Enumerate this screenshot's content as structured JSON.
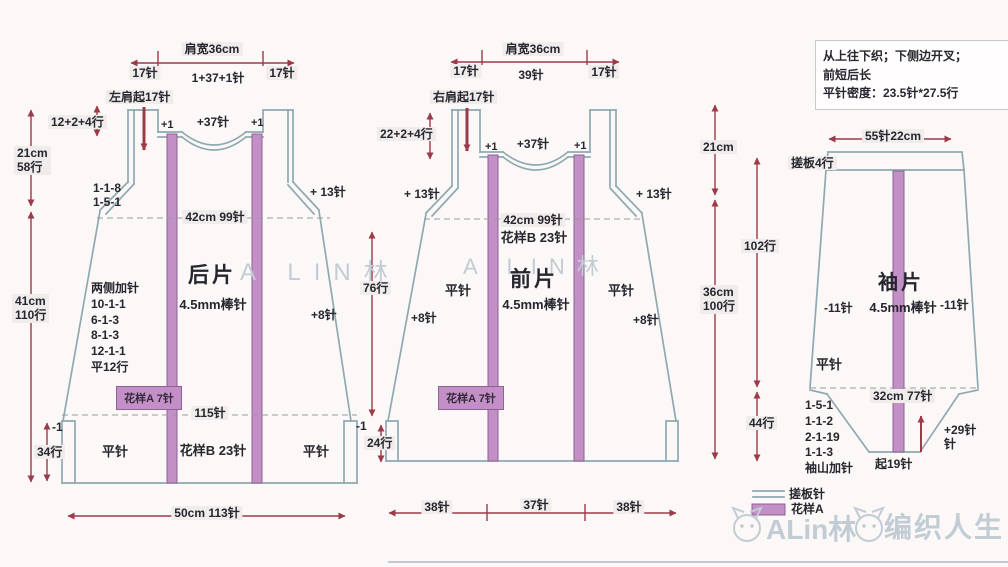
{
  "info_box": {
    "line1": "从上往下织；下侧边开叉；",
    "line2": "前短后长",
    "line3": "平针密度：23.5针*27.5行"
  },
  "back": {
    "title": "后片",
    "needle": "4.5mm棒针",
    "shoulder_width": "肩宽36cm",
    "seg_left": "17针",
    "seg_center": "1+37+1针",
    "seg_right": "17针",
    "shoulder_start": "左肩起17针",
    "shoulder_rows": "12+2+4行",
    "plus1_left": "+1",
    "neck_sts": "+37针",
    "plus1_right": "+1",
    "armhole_left": "1-1-8\n1-5-1",
    "armhole_right": "+ 13针",
    "yoke_len": "21cm\n58行",
    "body_len": "41cm\n110行",
    "chest": "42cm 99针",
    "side_inc": "两侧加针\n10-1-1\n6-1-3\n8-1-3\n12-1-1\n平12行",
    "inc_right": "+8针",
    "patternA": "花样A 7针",
    "hem_sts": "115针",
    "patternB": "花样B 23针",
    "stockinette_left": "平针",
    "stockinette_right": "平针",
    "minus1": "-1",
    "hem_rows": "34行",
    "bottom_width": "50cm 113针"
  },
  "front": {
    "title": "前片",
    "needle": "4.5mm棒针",
    "shoulder_width": "肩宽36cm",
    "seg_left": "17针",
    "seg_center": "39针",
    "seg_right": "17针",
    "shoulder_start": "右肩起17针",
    "shoulder_rows": "22+2+4行",
    "plus1_left": "+1",
    "neck_sts": "+37针",
    "plus1_right": "+1",
    "armhole_left": "+ 13针",
    "armhole_right": "+ 13针",
    "chest": "42cm 99针",
    "patternB": "花样B 23针",
    "stockinette_left": "平针",
    "stockinette_right": "平针",
    "inc_left": "+8针",
    "inc_right": "+8针",
    "patternA": "花样A 7针",
    "mid_rows": "76行",
    "minus1": "-1",
    "hem_rows": "24行",
    "bottom_left": "38针",
    "bottom_center": "37针",
    "bottom_right": "38针"
  },
  "sleeve": {
    "title": "袖片",
    "needle": "4.5mm棒针",
    "top_width": "55针22cm",
    "garter": "搓板4行",
    "len_top": "21cm",
    "len_body": "36cm\n100行",
    "rows_upper": "102行",
    "rows_cap": "44行",
    "dec_left": "-11针",
    "dec_right": "-11针",
    "stockinette": "平针",
    "underarm": "32cm 77针",
    "cap_shaping": "1-5-1\n1-1-2\n2-1-19\n1-1-3\n袖山加针",
    "cast_on": "起19针",
    "cap_inc": "+29针\n针"
  },
  "legend": {
    "garter_label": "搓板针",
    "patternA_label": "花样A"
  },
  "watermark": {
    "center_back": "A LIN林",
    "center_front": "A LIN林",
    "brand_name": "ALin林",
    "brand_site": "编织人生"
  },
  "colors": {
    "outline": "#8fa9b1",
    "pattern_fill": "#c28fc6",
    "pattern_border": "#8f6293",
    "arrow": "#9c3a48",
    "text": "#26262e",
    "label_bg": "#f1ecec",
    "watermark": "#c2ccd4",
    "background": "#fbf8f7",
    "box_border": "#c9c9c9"
  }
}
